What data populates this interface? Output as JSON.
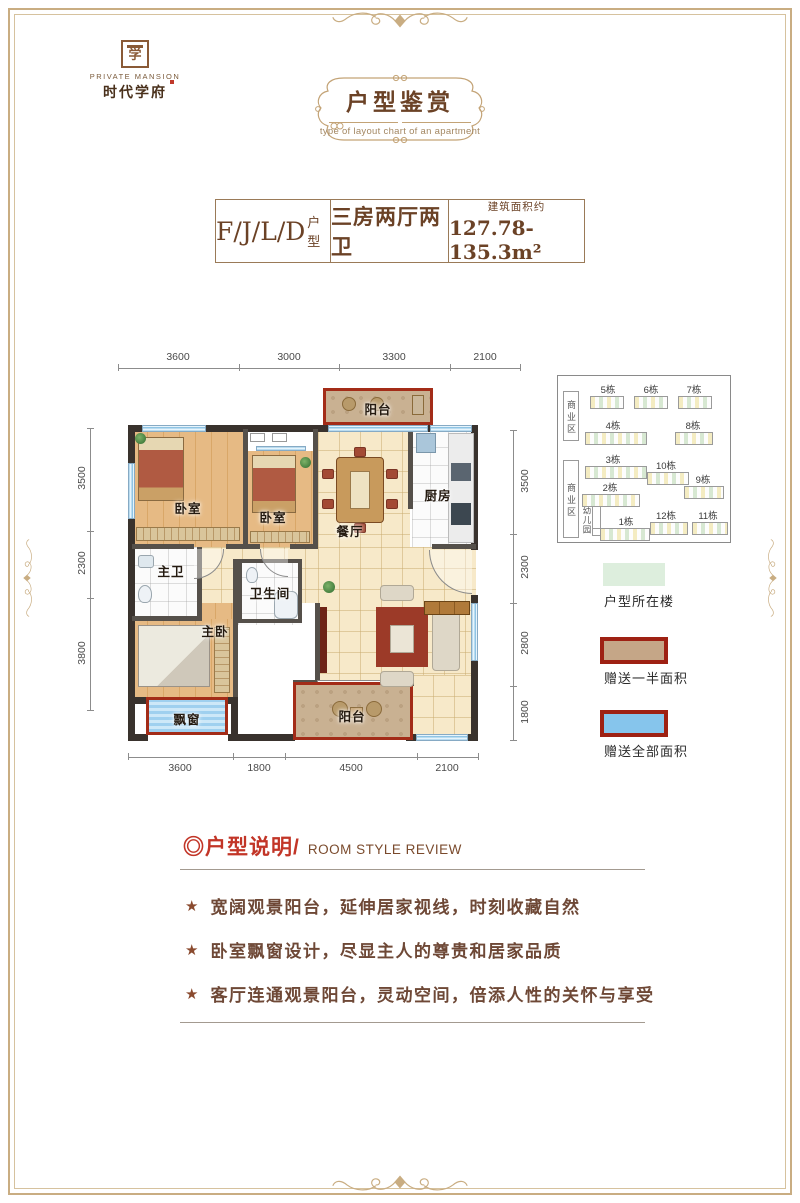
{
  "logo": {
    "seal_char": "学",
    "en": "PRIVATE MANSION",
    "cn": "时代学府"
  },
  "header": {
    "title": "户型鉴赏",
    "subtitle": "type of layout chart of an apartment"
  },
  "unit_bar": {
    "code": "F/J/L/D",
    "code_suffix": "户型",
    "layout": "三房两厅两卫",
    "area_label": "建筑面积约",
    "area_value": "127.78-135.3m²"
  },
  "floor_plan": {
    "dims_top": [
      "3600",
      "3000",
      "3300",
      "2100"
    ],
    "dims_bottom": [
      "3600",
      "1800",
      "4500",
      "2100"
    ],
    "dims_left": [
      "3500",
      "2300",
      "3800"
    ],
    "dims_right": [
      "3500",
      "2300",
      "2800",
      "1800"
    ],
    "rooms": {
      "balcony_top": "阳台",
      "bedroom_a": "卧室",
      "bedroom_b": "卧室",
      "dining": "餐厅",
      "kitchen": "厨房",
      "master_bath": "主卫",
      "bathroom": "卫生间",
      "master_bedroom": "主卧",
      "bay_window": "飘窗",
      "balcony_bottom": "阳台"
    }
  },
  "site_plan": {
    "commercial_top": "商业区",
    "commercial_bottom": "商业区",
    "kindergarten": "幼儿园",
    "buildings": [
      "5栋",
      "6栋",
      "7栋",
      "4栋",
      "8栋",
      "3栋",
      "10栋",
      "2栋",
      "9栋",
      "1栋",
      "12栋",
      "11栋"
    ]
  },
  "legend": {
    "items": [
      {
        "label": "户型所在楼",
        "color": "#ddeedd"
      },
      {
        "label": "赠送一半面积",
        "color": "#c5a687",
        "border": "#9e2113"
      },
      {
        "label": "赠送全部面积",
        "color": "#86c5ec",
        "border": "#9e2113"
      }
    ]
  },
  "review": {
    "title_cn": "◎户型说明/",
    "title_en": "ROOM STYLE REVIEW",
    "bullet_icon": "★",
    "bullets": [
      "宽阔观景阳台，延伸居家视线，时刻收藏自然",
      "卧室飘窗设计，尽显主人的尊贵和居家品质",
      "客厅连通观景阳台，灵动空间，倍添人性的关怀与享受"
    ]
  },
  "colors": {
    "accent_red": "#9e2113",
    "frame_gold": "#c9ad82",
    "wall_dark": "#39322d",
    "wood_floor": "#e0b27c",
    "tile_floor": "#f6e8c8",
    "balcony_tan": "#c8b091",
    "window_blue": "#86c5ec",
    "legend_green": "#ddeedd",
    "text_brown": "#6b4226",
    "review_red": "#c23527"
  }
}
